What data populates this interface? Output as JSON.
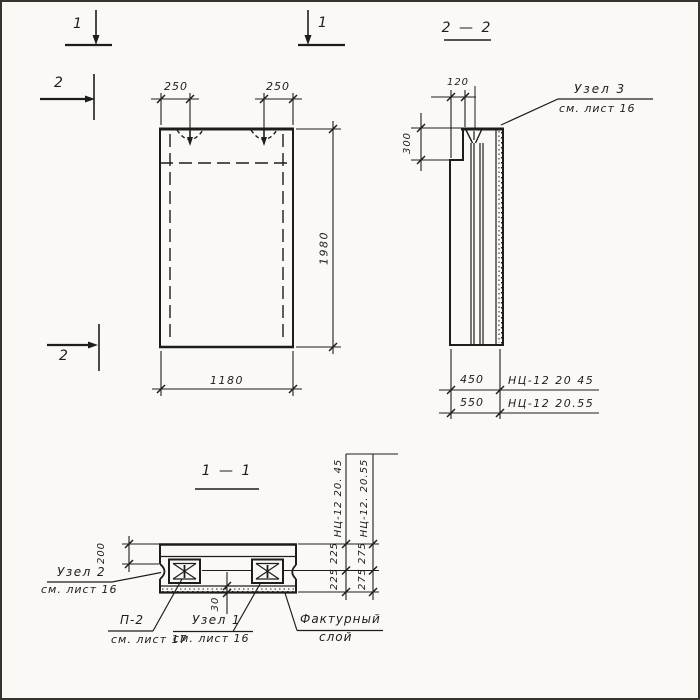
{
  "colors": {
    "ink": "#1d1d1b",
    "paper": "#faf9f5"
  },
  "markers": {
    "cut1_left": "1",
    "cut1_right": "1",
    "cut2_top": "2",
    "cut2_bottom": "2"
  },
  "front_view": {
    "dim_loop_left": "250",
    "dim_loop_right": "250",
    "dim_height": "1980",
    "dim_width": "1180"
  },
  "section_2_2": {
    "title": "2 — 2",
    "dim_top_offset": "120",
    "dim_step_height": "300",
    "row1": {
      "dim": "450",
      "mark": "НЦ-12 20 45"
    },
    "row2": {
      "dim": "550",
      "mark": "НЦ-12 20.55"
    },
    "node3_label": "Узел 3",
    "node3_ref": "см. лист 16"
  },
  "section_1_1": {
    "title": "1 — 1",
    "dim_rib": "200",
    "dim_facing_layer": "30",
    "col1": {
      "mark": "НЦ-12 20. 45",
      "top": "225",
      "bottom": "225"
    },
    "col2": {
      "mark": "НЦ-12. 20.55",
      "top": "275",
      "bottom": "275"
    },
    "node2_label": "Узел 2",
    "node2_ref": "см. лист 16",
    "p2_label": "П-2",
    "p2_ref": "см. лист 17",
    "node1_label": "Узел 1",
    "node1_ref": "см. лист 16",
    "facing_line1": "Фактурный",
    "facing_line2": "слой"
  }
}
